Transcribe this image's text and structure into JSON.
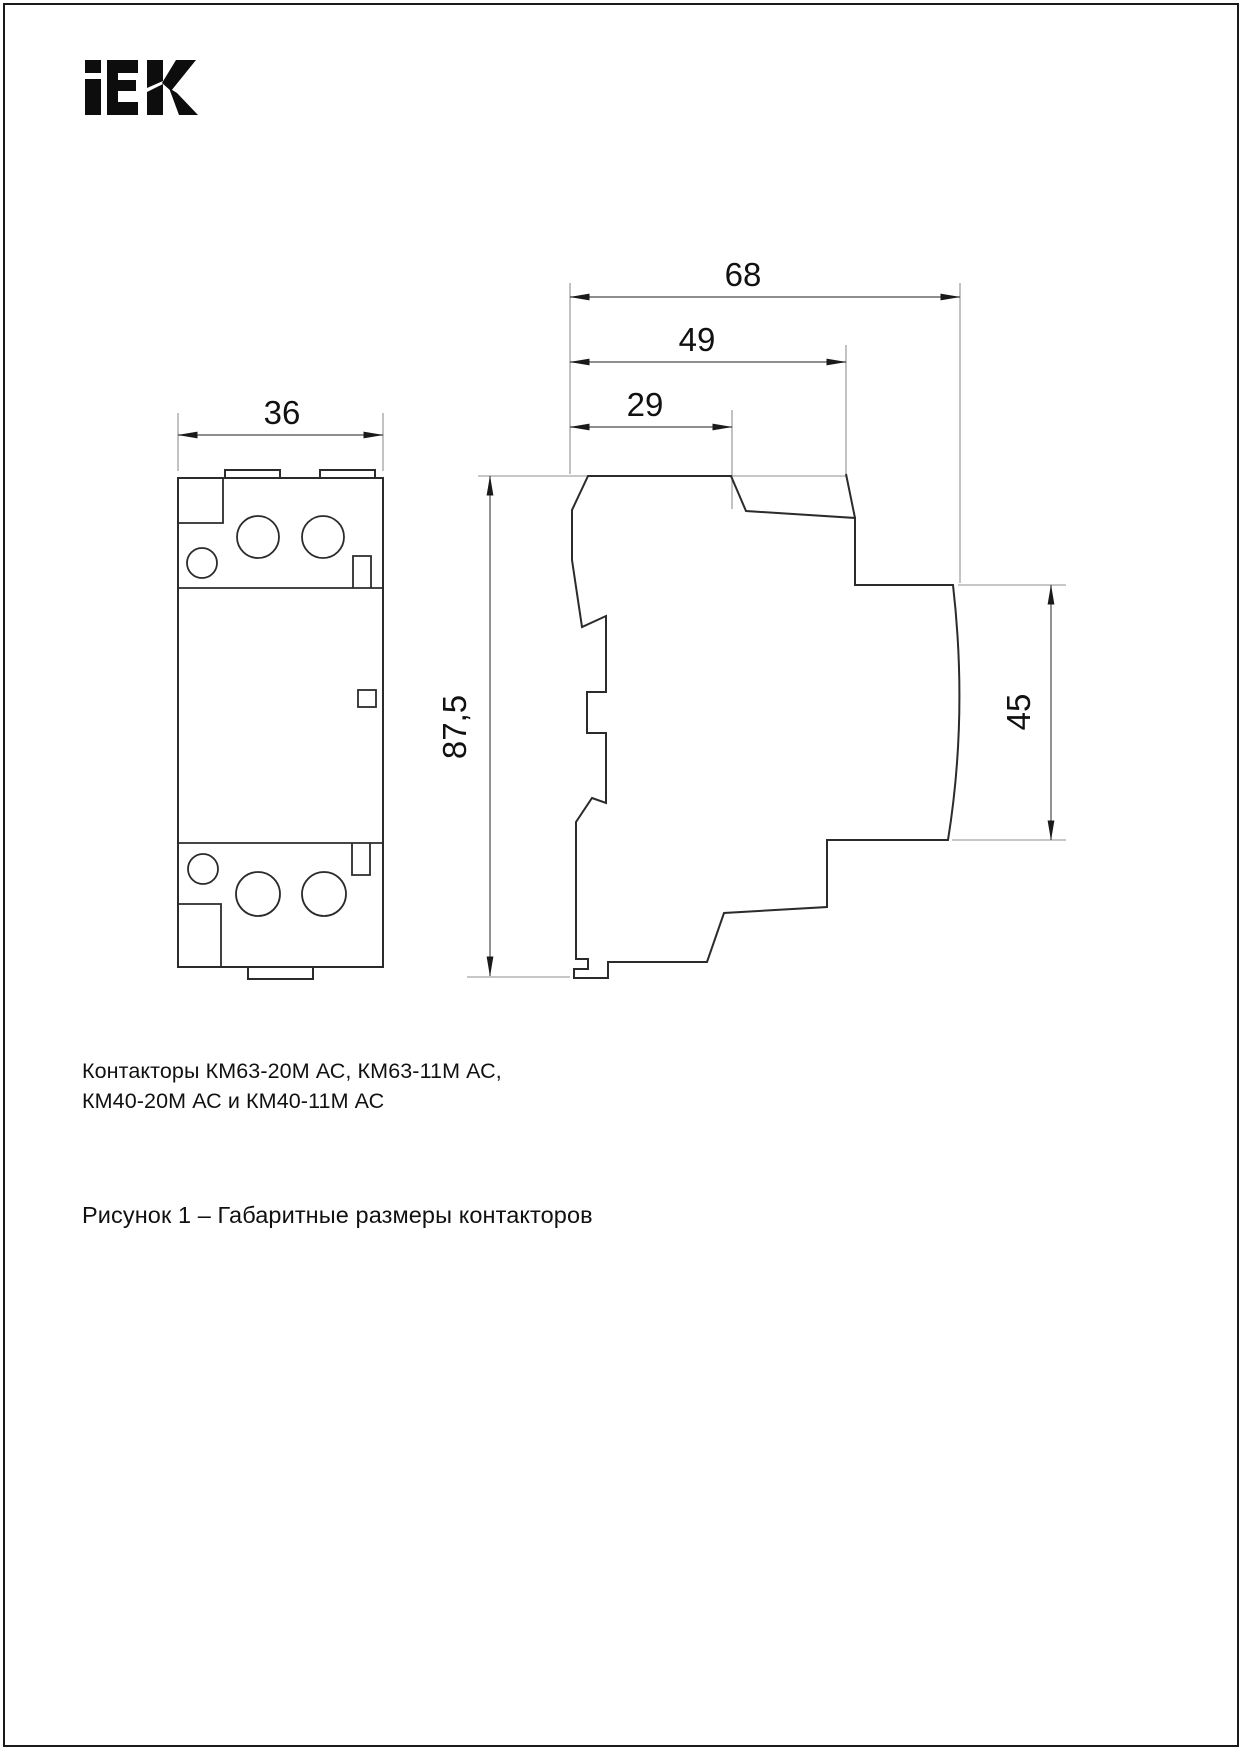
{
  "page": {
    "background": "#ffffff",
    "border_color": "#1a1a1a"
  },
  "logo": {
    "brand": "IEK",
    "color": "#0d0d0d"
  },
  "dims": {
    "front_width": "36",
    "depth_total": "68",
    "depth_mid": "49",
    "depth_top": "29",
    "height": "87,5",
    "front_height": "45"
  },
  "figure": {
    "product_lines": [
      "Контакторы КМ63-20М АС, КМ63-11М АС,",
      "КМ40-20М АС и КМ40-11М АС"
    ],
    "caption": "Рисунок 1 – Габаритные размеры контакторов"
  },
  "drawing": {
    "type": "technical-drawing",
    "views": [
      "front-view",
      "side-view"
    ],
    "line_color": "#2b2b2b",
    "extension_line_color": "#8f8f8f"
  }
}
